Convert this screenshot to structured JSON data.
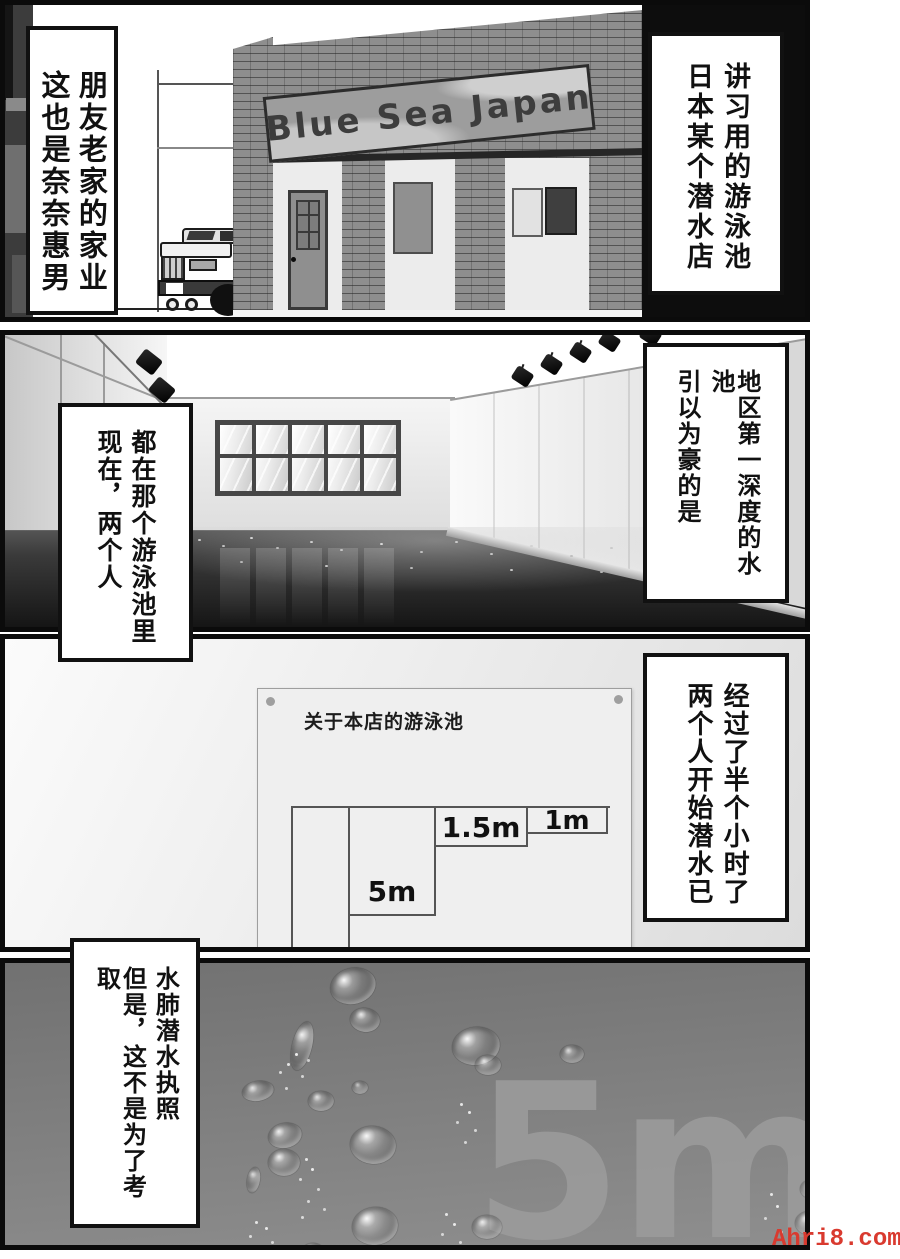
{
  "panel1": {
    "sign_text": "Blue Sea Japan",
    "caption_left": {
      "col1": "这也是奈奈惠男",
      "col2": "朋友老家的家业"
    },
    "caption_right": {
      "col1": "日本某个潜水店",
      "col2": "讲习用的游泳池"
    }
  },
  "panel2": {
    "caption_right": {
      "col1": "引以为豪的是",
      "col2": "地区第一深度的水池"
    },
    "caption_left": {
      "col1": "现在，两个人",
      "col2": "都在那个游泳池里"
    }
  },
  "panel3": {
    "caption_right": {
      "col1": "两个人开始潜水已",
      "col2": "经过了半个小时了"
    },
    "poster": {
      "title": "关于本店的游泳池",
      "depth_shallow": "1m",
      "depth_mid": "1.5m",
      "depth_deep": "5m"
    }
  },
  "panel4": {
    "caption_left": {
      "col1": "但是，这不是为了考取",
      "col2": "水肺潜水执照"
    },
    "depth_watermark": "5m"
  },
  "site_watermark": {
    "text": "Ahri8.com",
    "color": "#d93a2f"
  }
}
